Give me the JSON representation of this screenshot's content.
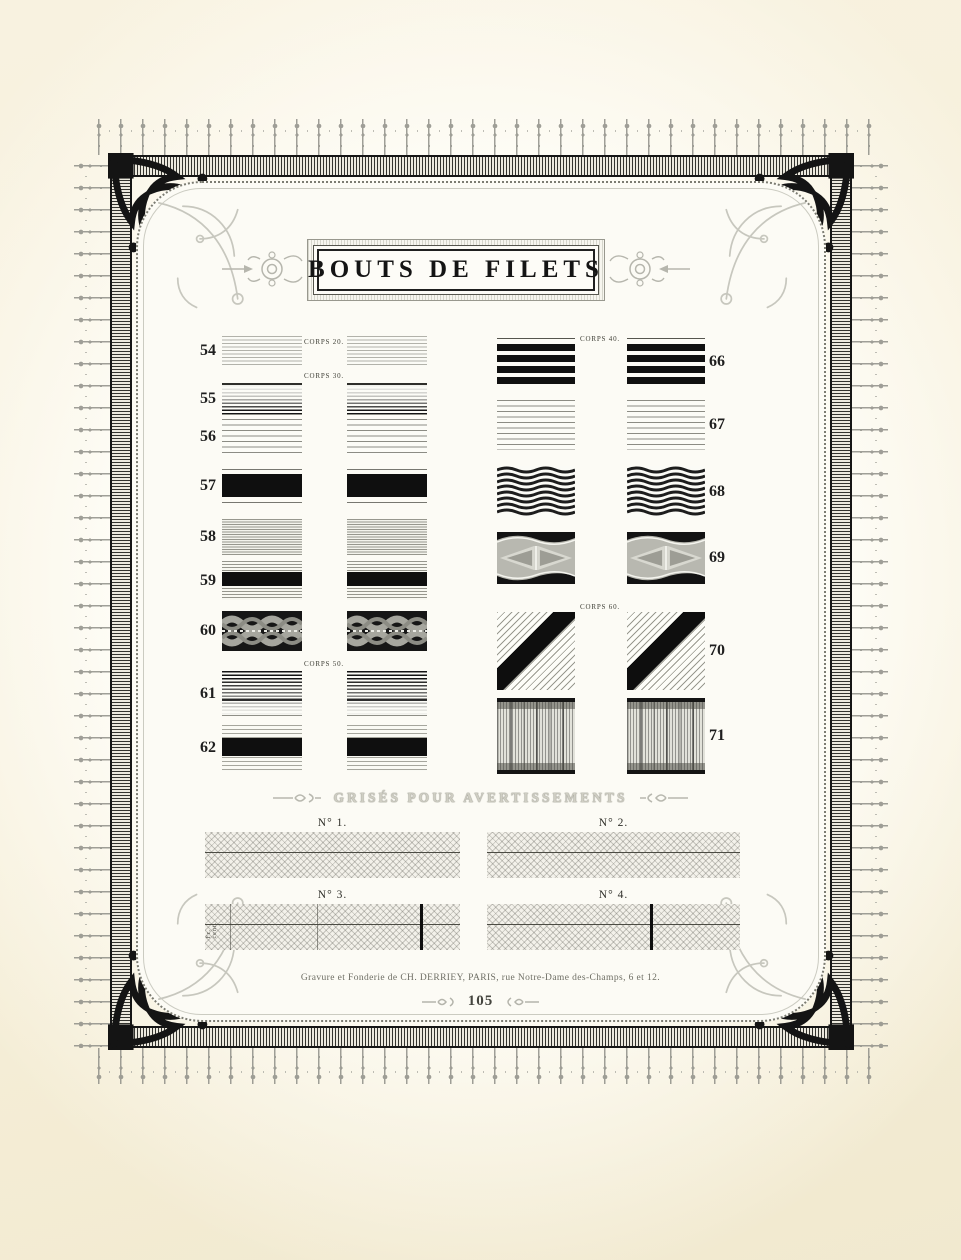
{
  "page": {
    "kind": "type specimen plate",
    "title": "BOUTS DE FILETS"
  },
  "specimens": {
    "left_rows": [
      {
        "num": "54",
        "caption": "CORPS 20.",
        "pattern": "lines-light"
      },
      {
        "num": "55",
        "caption": "CORPS 30.",
        "pattern": "grad-down"
      },
      {
        "num": "56",
        "pattern": "sparse-lines"
      },
      {
        "num": "57",
        "pattern": "black-bar"
      },
      {
        "num": "58",
        "pattern": "fine-lines"
      },
      {
        "num": "59",
        "pattern": "bar-lines"
      },
      {
        "num": "60",
        "pattern": "wave-band"
      },
      {
        "num": "61",
        "caption": "CORPS 50.",
        "pattern": "grad-up"
      },
      {
        "num": "62",
        "pattern": "bar-lines-wide"
      }
    ],
    "right_rows": [
      {
        "num": "66",
        "caption": "CORPS 40.",
        "pattern": "black-bars"
      },
      {
        "num": "67",
        "pattern": "sparse-lines"
      },
      {
        "num": "68",
        "pattern": "wave-lines"
      },
      {
        "num": "69",
        "pattern": "ornament-band"
      },
      {
        "num": "70",
        "caption": "CORPS 60.",
        "pattern": "diagonal-band"
      },
      {
        "num": "71",
        "pattern": "pillar-band"
      }
    ]
  },
  "grises": {
    "heading": "GRISÉS POUR AVERTISSEMENTS",
    "blocks": [
      {
        "label": "N° 1."
      },
      {
        "label": "N° 2."
      },
      {
        "label": "N° 3.",
        "side_label": "Fr.  cent."
      },
      {
        "label": "N° 4."
      }
    ]
  },
  "footer": {
    "imprint": "Gravure et Fonderie de CH. DERRIEY, PARIS, rue Notre-Dame des-Champs, 6 et 12.",
    "page_number": "105"
  },
  "ornaments": {
    "frame": "engraved border with outer fringe, hatched band, corner arabesques, beaded inner panel",
    "icons": [
      "corner-arabesque-icon",
      "corner-flourish-icon",
      "title-rosette-icon",
      "squiggle-icon"
    ]
  }
}
